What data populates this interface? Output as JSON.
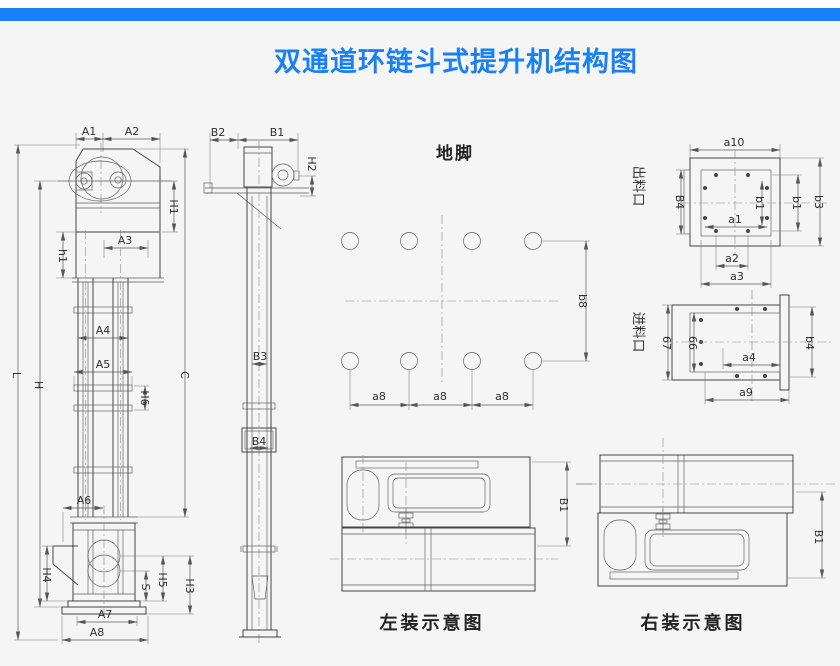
{
  "page": {
    "title": "双通道环链斗式提升机结构图",
    "accent_color": "#1a80f5",
    "background_color": "#f5f5f6"
  },
  "front_view": {
    "dims": {
      "A1": "A1",
      "A2": "A2",
      "A3": "A3",
      "A4": "A4",
      "A5": "A5",
      "A6": "A6",
      "A7": "A7",
      "A8": "A8",
      "h1": "h1",
      "H1": "H1",
      "H3": "H3",
      "H4": "H4",
      "H5": "H5",
      "H6": "H6",
      "S": "S",
      "L": "L",
      "H": "H",
      "C": "C"
    }
  },
  "side_view": {
    "dims": {
      "B1": "B1",
      "B2": "B2",
      "B3": "B3",
      "B4": "B4",
      "H2": "H2"
    }
  },
  "foundation": {
    "title": "地脚",
    "dims": {
      "a8a": "a8",
      "a8b": "a8",
      "a8c": "a8",
      "b8": "b8"
    }
  },
  "outlet": {
    "label": "出料口",
    "dims": {
      "a10": "a10",
      "B4": "B4",
      "b1_inner": "b1",
      "b1_outer": "b1",
      "b3": "b3",
      "a1": "a1",
      "a2": "a2",
      "a3": "a3"
    }
  },
  "inlet": {
    "label": "进料口",
    "dims": {
      "v67": "67",
      "v66": "66",
      "a4": "a4",
      "b4": "b4",
      "a9": "a9"
    }
  },
  "install_left": {
    "caption": "左装示意图",
    "dim_B1": "B1"
  },
  "install_right": {
    "caption": "右装示意图",
    "dim_B1": "B1"
  }
}
